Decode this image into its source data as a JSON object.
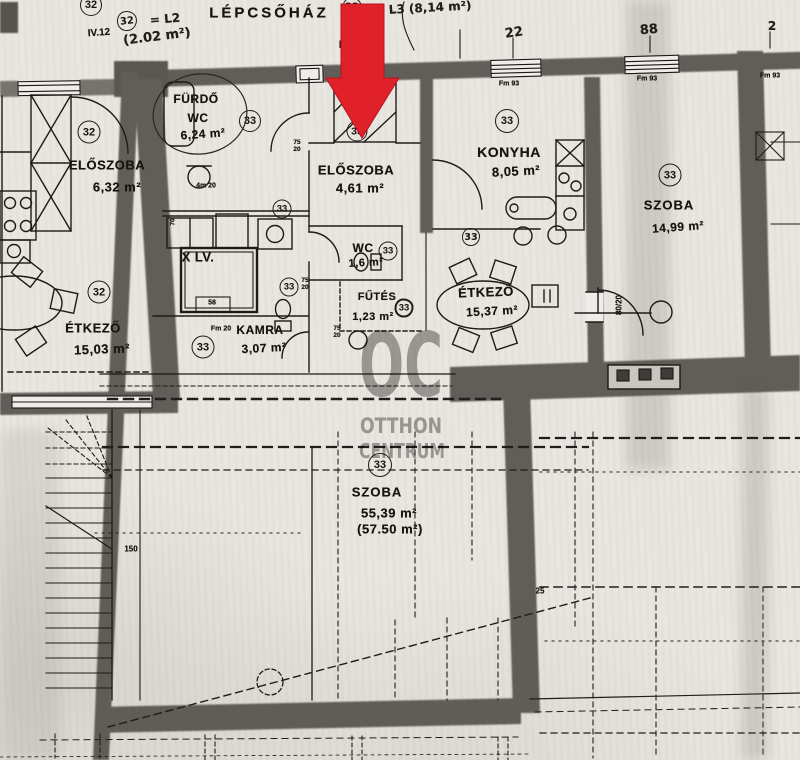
{
  "colors": {
    "arrow_red": "#e0212a",
    "watermark_gray": "#989896",
    "paper": "#e9e6e1",
    "wall_gray": "#53504b"
  },
  "watermark": {
    "logo": "OC",
    "line1": "OTTHON",
    "line2": "CENTRUM"
  },
  "header": {
    "stairwell_label": "LÉPCSŐHÁZ",
    "apartment_left_no": "IV.12",
    "apartment_mid_no": "IV.1",
    "note_left_unit": "32",
    "note_left_eq": "= L2",
    "note_left_area": "(2.02 m²)",
    "note_right_unit": "32",
    "note_right_eq": "= L3 (8,14 m²)",
    "dim_top_a": "22",
    "dim_top_b": "88",
    "dim_top_c": "2",
    "wall_mark": "Fm 93"
  },
  "rooms": {
    "eloszoba_left": {
      "name": "ELŐSZOBA",
      "area": "6,32 m²",
      "unit": "32"
    },
    "furdo": {
      "name": "FÜRDŐ",
      "name2": "WC",
      "area": "6,24 m²",
      "unit": "33"
    },
    "eloszoba_mid": {
      "name": "ELŐSZOBA",
      "area": "4,61 m²",
      "unit": "33"
    },
    "konyha": {
      "name": "KONYHA",
      "area": "8,05 m²",
      "unit": "33"
    },
    "szoba_right": {
      "name": "SZOBA",
      "area": "14,99 m²",
      "unit": "33"
    },
    "wc": {
      "name": "WC",
      "area": "1,6 m²",
      "unit": "33"
    },
    "futes": {
      "name": "FŰTÉS",
      "area": "1,23 m²",
      "unit": "33"
    },
    "etkezo_mid": {
      "name": "ÉTKEZŐ",
      "area": "15,37 m²",
      "unit": "33"
    },
    "kamra": {
      "name": "KAMRA",
      "area": "3,07 m²",
      "unit": "33"
    },
    "etkezo_left": {
      "name": "ÉTKEZŐ",
      "area": "15,03 m²",
      "unit": "32"
    },
    "szoba_attic": {
      "name": "SZOBA",
      "area": "55,39 m²",
      "area_alt": "(57.50 m²)",
      "unit": "33"
    },
    "lift": {
      "name": "X LV."
    }
  },
  "extra_units": {
    "top_left": "32",
    "bath_upper": "33",
    "bath_lower": "33"
  },
  "small_dims": {
    "fm20": "Fm 20",
    "sink": "4m 20",
    "d75_20": "75\n20",
    "d80_20": "80/20",
    "d150": "150",
    "d25": "25",
    "d58": "58",
    "d70": "70"
  }
}
